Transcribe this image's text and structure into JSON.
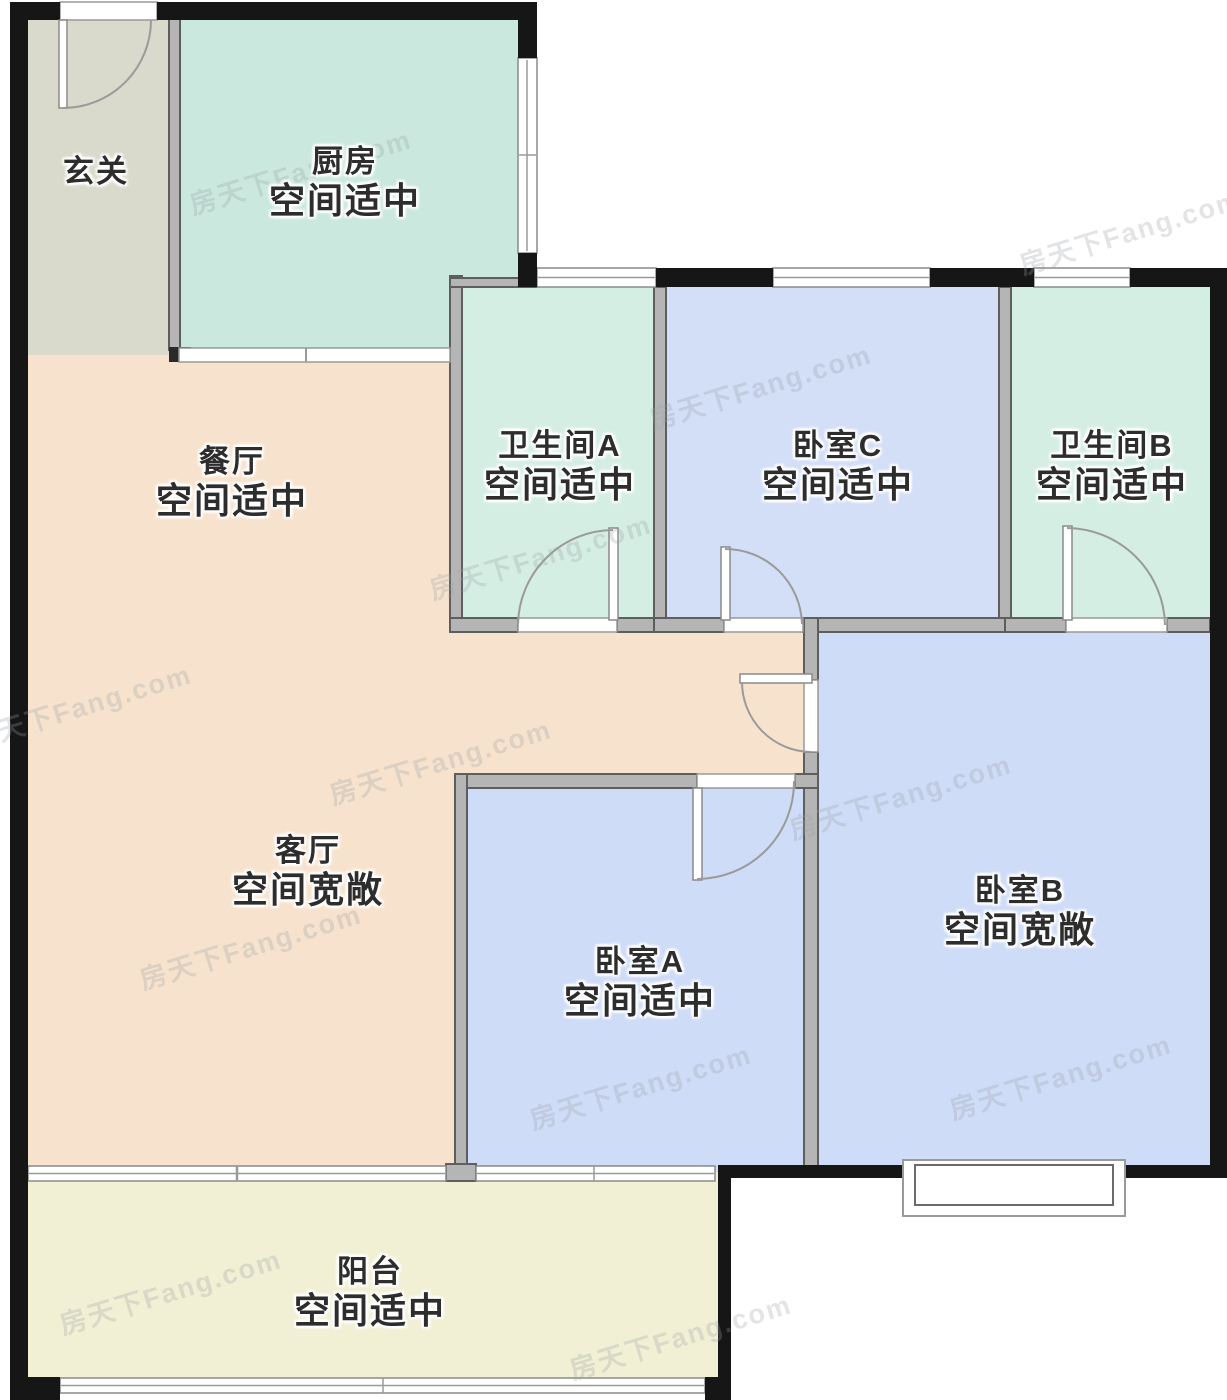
{
  "page": {
    "type": "residential-floor-plan"
  },
  "watermark": {
    "text": "房天下Fang.com"
  },
  "palette": {
    "exterior_wall": "#161616",
    "interior_wall": "#b5b5b5",
    "entry_floor": "#d9d9cc",
    "kitchen_floor": "#cbe8de",
    "bathroom_floor": "#d5eee4",
    "living_dining_floor": "#f7e3cd",
    "bedroom_floor": "#cfdcf7",
    "balcony_floor": "#f1f0d5",
    "label_text": "#2d2d2d"
  },
  "rooms": [
    {
      "id": "entry",
      "name": "玄关",
      "status": ""
    },
    {
      "id": "kitchen",
      "name": "厨房",
      "status": "空间适中"
    },
    {
      "id": "dining",
      "name": "餐厅",
      "status": "空间适中"
    },
    {
      "id": "bathroom-a",
      "name": "卫生间A",
      "status": "空间适中"
    },
    {
      "id": "bedroom-c",
      "name": "卧室C",
      "status": "空间适中"
    },
    {
      "id": "bathroom-b",
      "name": "卫生间B",
      "status": "空间适中"
    },
    {
      "id": "living",
      "name": "客厅",
      "status": "空间宽敞"
    },
    {
      "id": "bedroom-a",
      "name": "卧室A",
      "status": "空间适中"
    },
    {
      "id": "bedroom-b",
      "name": "卧室B",
      "status": "空间宽敞"
    },
    {
      "id": "balcony",
      "name": "阳台",
      "status": "空间适中"
    }
  ]
}
